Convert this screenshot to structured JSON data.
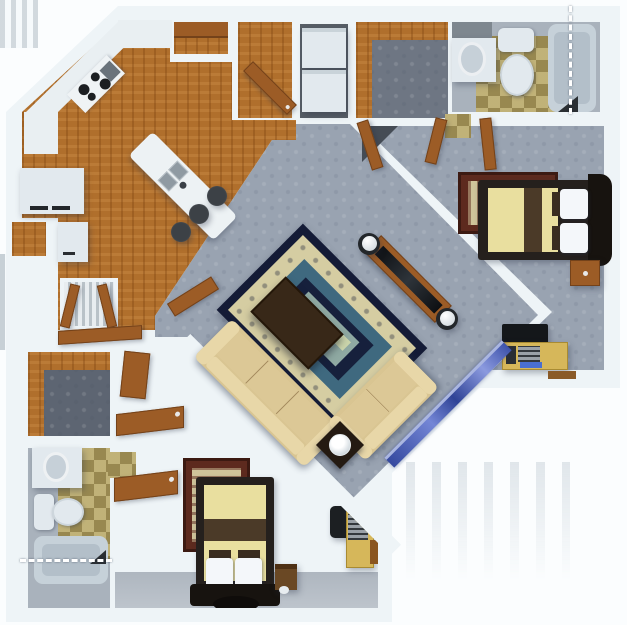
{
  "palette": {
    "wall": "#eef4f7",
    "wood": "#b06f2c",
    "woodDark": "#8a5017",
    "carpet": "#99a3b1",
    "closetCarpet": "#5d6572",
    "closetCarpetTR": "#6e7683",
    "laundryFloor": "#575e66",
    "bathFloor": "#a9b2bc",
    "tileA": "#b2a166",
    "fixture": "#e2e9ee",
    "fixtureShade": "#c6d0d8",
    "counter": "#e9eff2",
    "doorWood": "#9c5c26",
    "doorWoodDark": "#74421a",
    "sofa": "#d9c592",
    "sofaLight": "#e8d7a8",
    "rugNavy": "#141b36",
    "rugCream": "#d5cda2",
    "rugTeal": "#3f697f",
    "rugCenter": "#8fa9a2",
    "rugCenterLight": "#ccd6ac",
    "bedSpread": "#e9df9f",
    "bedBand": "#4b3a28",
    "bedFrame": "#25201d",
    "headboard": "#17130f",
    "pillow": "#f4f7fa",
    "pillowSq": "#3a2d20",
    "glassA": "#35499f",
    "glassB": "#7486d6",
    "deskWood": "#d6b75a",
    "orientalBorder": "#5d2a1e",
    "orientalInner": "#cfc49a",
    "tvDark": "#14171a",
    "metal": "#9aa1a8",
    "keyboardBlue": "#4a6fd0",
    "hamper": "#6a4824",
    "patio": "#fbfdfe",
    "stripe": "#d3dbe1",
    "stairStripe": "#c7d0d6",
    "stool": "#3c4146",
    "coffeeTable": "#382818",
    "endTable": "#241a12"
  }
}
